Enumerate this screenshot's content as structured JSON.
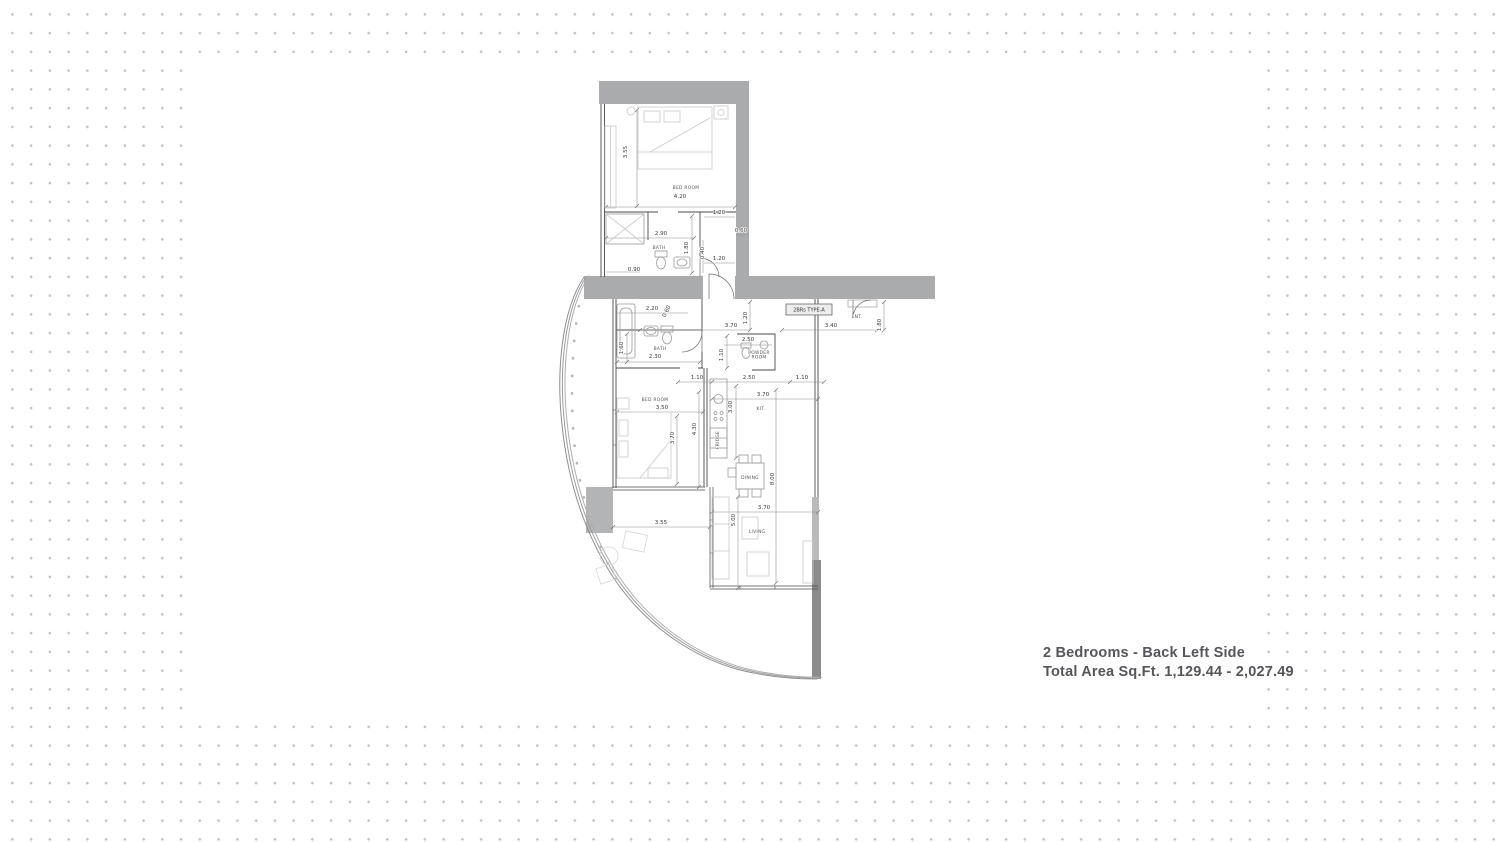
{
  "caption": {
    "line1": "2 Bedrooms - Back Left Side",
    "line2": "Total Area Sq.Ft. 1,129.44 - 2,027.49"
  },
  "plan": {
    "unit_tag": "2BRs TYPE-A",
    "room_labels": [
      {
        "text": "BED ROOM",
        "x": 686,
        "y": 189,
        "size": 4.2
      },
      {
        "text": "BATH",
        "x": 659,
        "y": 249,
        "size": 4.2
      },
      {
        "text": "BATH",
        "x": 660,
        "y": 350,
        "size": 4.2
      },
      {
        "text": "POWDER",
        "x": 759,
        "y": 354,
        "size": 3.3
      },
      {
        "text": "ROOM",
        "x": 759,
        "y": 358.5,
        "size": 3.3
      },
      {
        "text": "BED ROOM",
        "x": 655,
        "y": 401,
        "size": 4.2
      },
      {
        "text": "KIT.",
        "x": 761,
        "y": 410,
        "size": 4.4
      },
      {
        "text": "DINING",
        "x": 750,
        "y": 479,
        "size": 4.2
      },
      {
        "text": "LIVING",
        "x": 757,
        "y": 533,
        "size": 4.4
      },
      {
        "text": "ENT.",
        "x": 857,
        "y": 318,
        "size": 4.4
      },
      {
        "text": "FRIDGE",
        "x": 719,
        "y": 440,
        "size": 2.8,
        "rot": -90
      }
    ],
    "dim_labels": [
      {
        "text": "3.55",
        "x": 627,
        "y": 152,
        "rot": -90
      },
      {
        "text": "4.20",
        "x": 680,
        "y": 198
      },
      {
        "text": "1.20",
        "x": 719,
        "y": 214
      },
      {
        "text": "0.60",
        "x": 741,
        "y": 232
      },
      {
        "text": "2.90",
        "x": 661,
        "y": 235
      },
      {
        "text": "1.80",
        "x": 688,
        "y": 248,
        "rot": -90
      },
      {
        "text": "0.40",
        "x": 704,
        "y": 253,
        "rot": -90
      },
      {
        "text": "1.20",
        "x": 719,
        "y": 260
      },
      {
        "text": "0.90",
        "x": 634,
        "y": 271
      },
      {
        "text": "2.20",
        "x": 652,
        "y": 310
      },
      {
        "text": "0.60",
        "x": 668,
        "y": 312,
        "rot": -65
      },
      {
        "text": "1.20",
        "x": 747,
        "y": 318,
        "rot": -90
      },
      {
        "text": "3.70",
        "x": 731,
        "y": 327
      },
      {
        "text": "3.40",
        "x": 831,
        "y": 327
      },
      {
        "text": "1.80",
        "x": 881,
        "y": 325,
        "rot": -90
      },
      {
        "text": "1.60",
        "x": 623,
        "y": 348,
        "rot": -90
      },
      {
        "text": "2.30",
        "x": 655,
        "y": 358
      },
      {
        "text": "2.50",
        "x": 748,
        "y": 341
      },
      {
        "text": "1.10",
        "x": 723,
        "y": 355,
        "rot": -90
      },
      {
        "text": "1.10",
        "x": 697,
        "y": 379
      },
      {
        "text": "2.50",
        "x": 749,
        "y": 379
      },
      {
        "text": "1.10",
        "x": 802,
        "y": 379
      },
      {
        "text": "3.50",
        "x": 662,
        "y": 409
      },
      {
        "text": "3.70",
        "x": 674,
        "y": 438,
        "rot": -90
      },
      {
        "text": "4.30",
        "x": 696,
        "y": 429,
        "rot": -90
      },
      {
        "text": "3.00",
        "x": 732,
        "y": 407,
        "rot": -90
      },
      {
        "text": "3.70",
        "x": 763,
        "y": 396
      },
      {
        "text": "8.00",
        "x": 774,
        "y": 479,
        "rot": -90
      },
      {
        "text": "3.55",
        "x": 661,
        "y": 524
      },
      {
        "text": "5.00",
        "x": 735,
        "y": 520,
        "rot": -90
      },
      {
        "text": "3.70",
        "x": 764,
        "y": 509
      }
    ],
    "colors": {
      "wall_gray": "#aaabad",
      "wall_dark": "#8a8b8d",
      "wall_medium": "#b9babc",
      "line_dark": "#4a4a4a",
      "dim_line": "#8c8c8c",
      "furniture": "#c9c9c9",
      "dot": "#c1c1c4",
      "caption_text": "#55565a"
    }
  }
}
